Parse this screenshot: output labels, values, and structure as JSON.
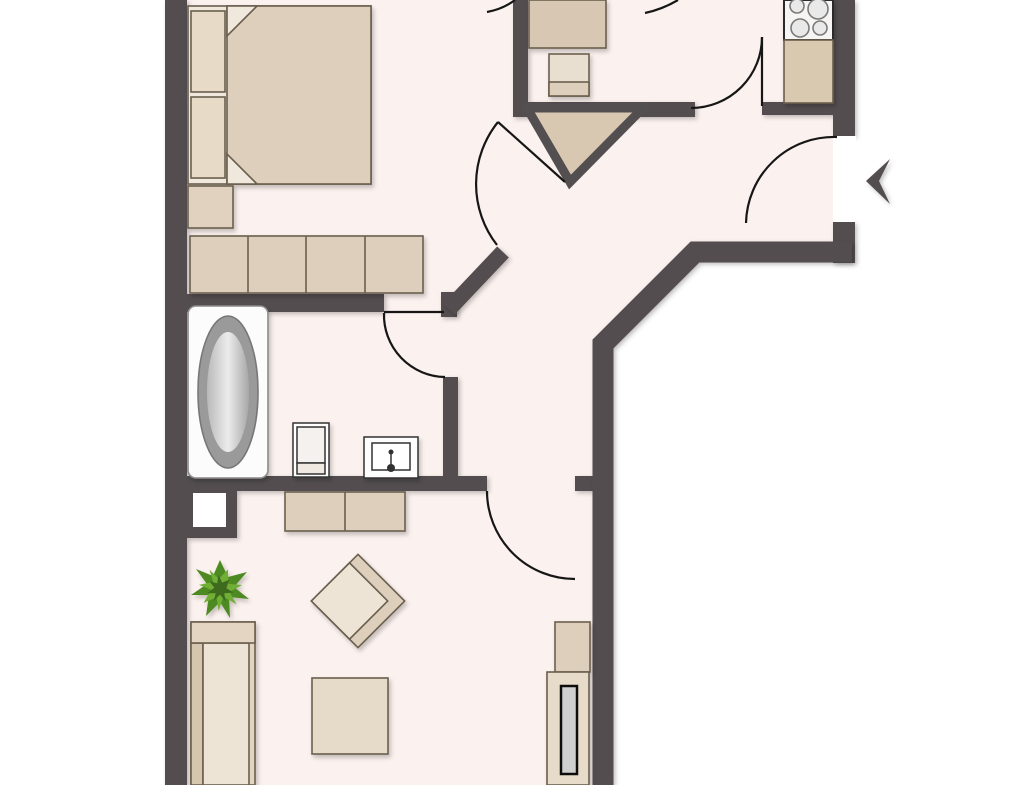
{
  "title": "apartment-floor-plan",
  "colors": {
    "outside": "#ffffff",
    "floor": "#fbf1ee",
    "wall": "#534e50",
    "door_line": "#161616",
    "beige_main": "#ddcfbc",
    "beige_light": "#eee4d6",
    "beige_mid": "#e3d5c2",
    "beige_dark": "#d8c8b2",
    "counter": "#d9c9b0",
    "tub_rim": "#9a9a9a",
    "appliance_white": "#f6f5f3",
    "tv_screen": "#cfcfcf",
    "plant_dark": "#3c6b1a",
    "plant_mid": "#4e8a24",
    "plant_light": "#6fae35",
    "furniture_border": "#6b5e4e"
  },
  "rooms": [
    {
      "name": "bedroom",
      "furniture": [
        "double-bed",
        "pillow",
        "pillow",
        "nightstand",
        "wardrobe-4-sections"
      ]
    },
    {
      "name": "kitchen",
      "furniture": [
        "dining-table",
        "chair",
        "stove-4-burners",
        "kitchen-counter"
      ]
    },
    {
      "name": "hallway",
      "furniture": []
    },
    {
      "name": "bathroom",
      "furniture": [
        "bathtub",
        "toilet",
        "sink"
      ]
    },
    {
      "name": "living-room",
      "furniture": [
        "sideboard",
        "potted-plant",
        "sofa",
        "armchair-rotated",
        "coffee-table",
        "tv-shelf",
        "tv-lowboard-with-screen"
      ]
    }
  ],
  "doors": [
    {
      "name": "entrance-door",
      "wall": "right-outer-wall",
      "swing": "inward"
    },
    {
      "name": "kitchen-door",
      "swing": "into-kitchen"
    },
    {
      "name": "bedroom-door",
      "swing": "into-hall",
      "position": "diagonal-wall"
    },
    {
      "name": "bathroom-door",
      "swing": "into-bathroom"
    },
    {
      "name": "living-room-door",
      "swing": "into-living-room"
    }
  ],
  "entrance_arrow": {
    "direction": "left",
    "meaning": "apartment-entrance"
  },
  "shaft": {
    "name": "installation-shaft",
    "shape": "white-square-in-wall-block"
  },
  "chimney": {
    "name": "triangular-shaft",
    "fill": "#d8c8b2"
  }
}
